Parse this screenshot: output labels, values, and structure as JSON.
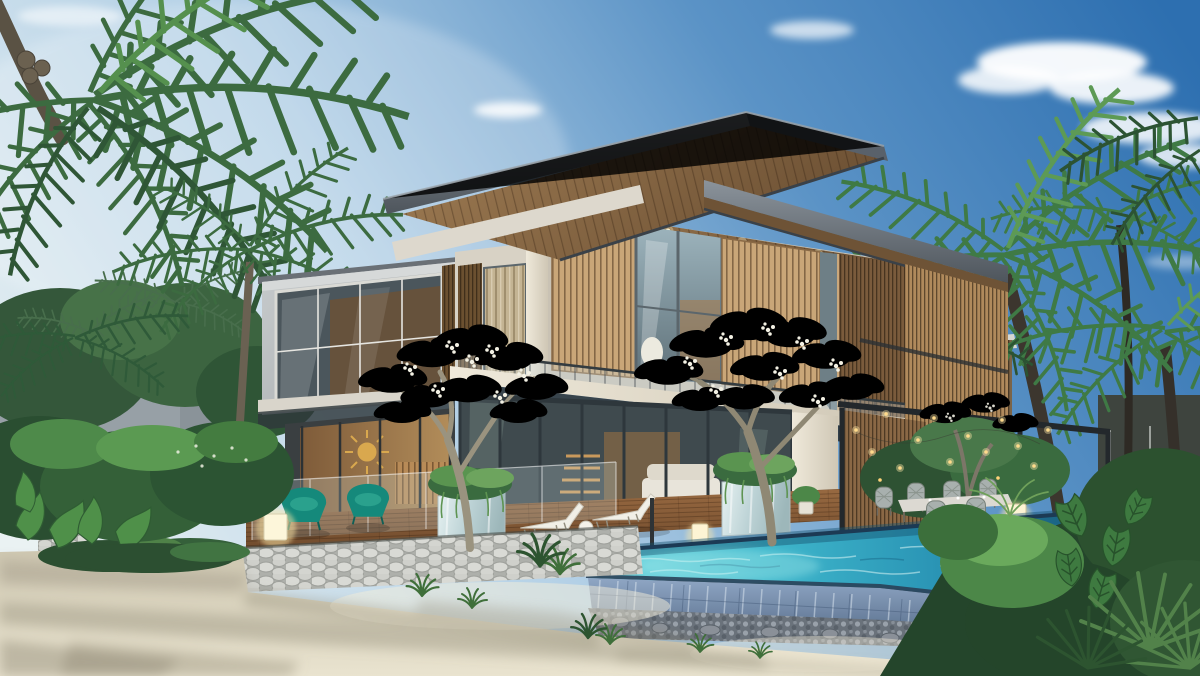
{
  "meta": {
    "title": "Photorealistic 3D exterior rendering of a modern two-storey tropical beachfront villa at golden hour",
    "width": 1200,
    "height": 676,
    "visible_text": "none"
  },
  "scene": {
    "description": "Two-storey contemporary villa with deep cantilevered flat roofs and warm timber soffits, vertical timber louvre screens over floor-to-ceiling glazing, a cool-gray cantilevered bedroom box on the left with a large window glowing warm inside, a glass-balustraded balcony, a timber pool deck with white sun loungers, teal armchairs, mirrored cube planters and glowing cube lamps, an infinity-edge pool with dark tiled overflow wall and pebble base over a dry-stone retaining wall, white sand beach in the foreground crossed by long soft tree shadows, flowering frangipani trees in front of the facade, coconut palms left and right, a slatted pergola dining terrace with woven chairs and string lights, and a neighbouring villa glimpsed through palms on the right",
    "time_of_day": "late afternoon golden hour",
    "sky": "clear blue sky, deepest top-right, pale toward the left horizon, scattered small white clouds",
    "elements": [
      "blue-sky",
      "clouds",
      "coconut-palms-left",
      "coconut-palms-right",
      "boundary-wall",
      "background-shrubs",
      "neighbour-villa",
      "main-villa",
      "upper-cantilevered-roof",
      "secondary-roof",
      "timber-roof-soffit",
      "timber-louvre-screens",
      "upper-floor-glazing",
      "balcony-glass-balustrade",
      "left-wing-concrete-box",
      "bedroom-window",
      "ground-floor-glazing",
      "interior-sunburst-art",
      "staircase",
      "sofa",
      "timber-deck",
      "glass-pool-fence",
      "sun-loungers",
      "teal-armchairs",
      "mirrored-planters",
      "cube-lamps",
      "pergola-louvre-wall",
      "outdoor-dining-set",
      "string-lights",
      "infinity-pool",
      "pool-overflow-tile-wall",
      "pebble-bed",
      "stone-retaining-wall",
      "frangipani-trees",
      "white-frangipani-flowers",
      "monstera-plants",
      "fan-palm",
      "sand-beach",
      "tree-shadows-on-sand"
    ]
  },
  "palette": {
    "sky_top": "#2d6fb0",
    "sky_horizon": "#eaf2f3",
    "cloud_white": "#ffffff",
    "fascia_dark": "#4e555c",
    "fascia_light": "#8b939b",
    "soffit_light": "#a07d54",
    "soffit_dark": "#6d5134",
    "slat_wood": "#c9a678",
    "slat_wood_dark": "#6b5030",
    "slat_wood_mid": "#b08a5c",
    "concrete_cream": "#e8e2d4",
    "concrete_gray": "#b6babc",
    "glass_cool": "#9db4bd",
    "glass_ground": "#3f4a4e",
    "interior_warm": "#c79a5e",
    "deck_light": "#9a6b42",
    "deck_dark": "#6f4a2c",
    "stone_wall": "#c9cbc6",
    "pool_light": "#7adbe2",
    "pool_deep": "#1f7396",
    "tile_light": "#8fa6c4",
    "tile_dark": "#5d7390",
    "pebble_dark": "#6a727b",
    "sand_near": "#e9e3cf",
    "sand_far": "#cfc8b2",
    "sand_shadow": "#8f8874",
    "foliage_dark": "#24452b",
    "foliage_mid": "#3a6b3f",
    "foliage_light": "#6da45e",
    "palm_left": "#3c6b40",
    "palm_right": "#3f7a45",
    "frangipani_flower": "#f3f1e4",
    "armchair_teal": "#15897b",
    "lamp_glow": "#ffe9a8",
    "trunk_gray": "#9a937f",
    "metal_dark": "#23282c"
  }
}
